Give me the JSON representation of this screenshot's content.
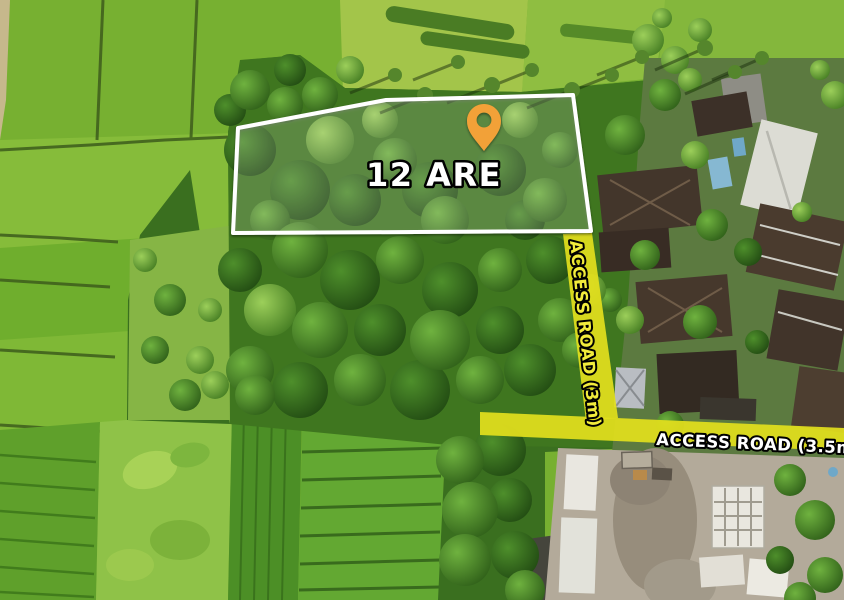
{
  "annotations": {
    "area_label": "12 ARE",
    "road_vertical_label": "ACCESS ROAD (3m)",
    "road_horizontal_label": "ACCESS ROAD (3.5m)"
  },
  "colors": {
    "pin": "#F2A138",
    "road_band": "#E2DF1D",
    "plot_border": "#FFFFFF",
    "area_text": "#FFFFFF",
    "road_vertical_text": "#F2EC3C",
    "road_horizontal_text": "#FFFFFF",
    "text_outline": "#000000"
  }
}
